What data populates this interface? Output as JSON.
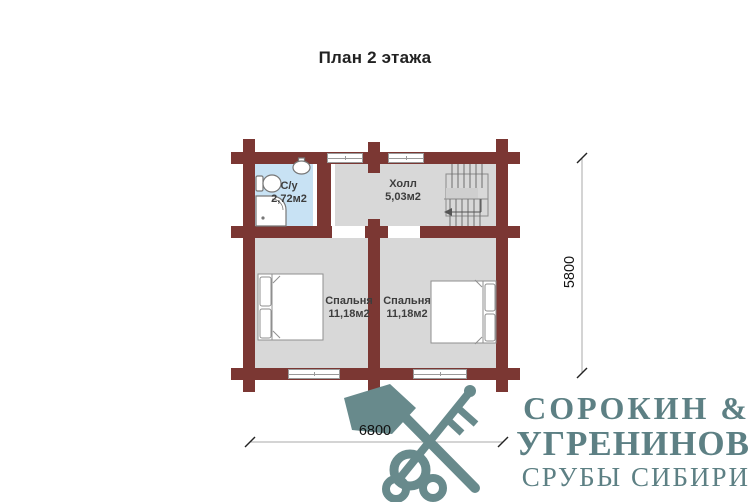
{
  "title": "План 2 этажа",
  "plan": {
    "rooms": {
      "bathroom": {
        "name": "С/у",
        "area": "2,72м2"
      },
      "hall": {
        "name": "Холл",
        "area": "5,03м2"
      },
      "bedroom_left": {
        "name": "Спальня",
        "area": "11,18м2"
      },
      "bedroom_right": {
        "name": "Спальня",
        "area": "11,18м2"
      }
    },
    "dimensions": {
      "width": "6800",
      "height": "5800"
    },
    "colors": {
      "wall": "#7b3733",
      "floor": "#d8d8d8",
      "bathroom_floor": "#c8e2f4",
      "dimension_line": "#aaaaaa"
    },
    "symbols": [
      "staircase",
      "toilet",
      "sink",
      "corner-shower",
      "double-bed",
      "double-bed",
      "window",
      "window",
      "window",
      "window"
    ]
  },
  "logo": {
    "name_line1": "СОРОКИН &",
    "name_line2": "УГРЕНИНОВ",
    "tagline": "СРУБЫ СИБИРИ",
    "color": "#5d8084",
    "icon": "axe-key-icon"
  }
}
